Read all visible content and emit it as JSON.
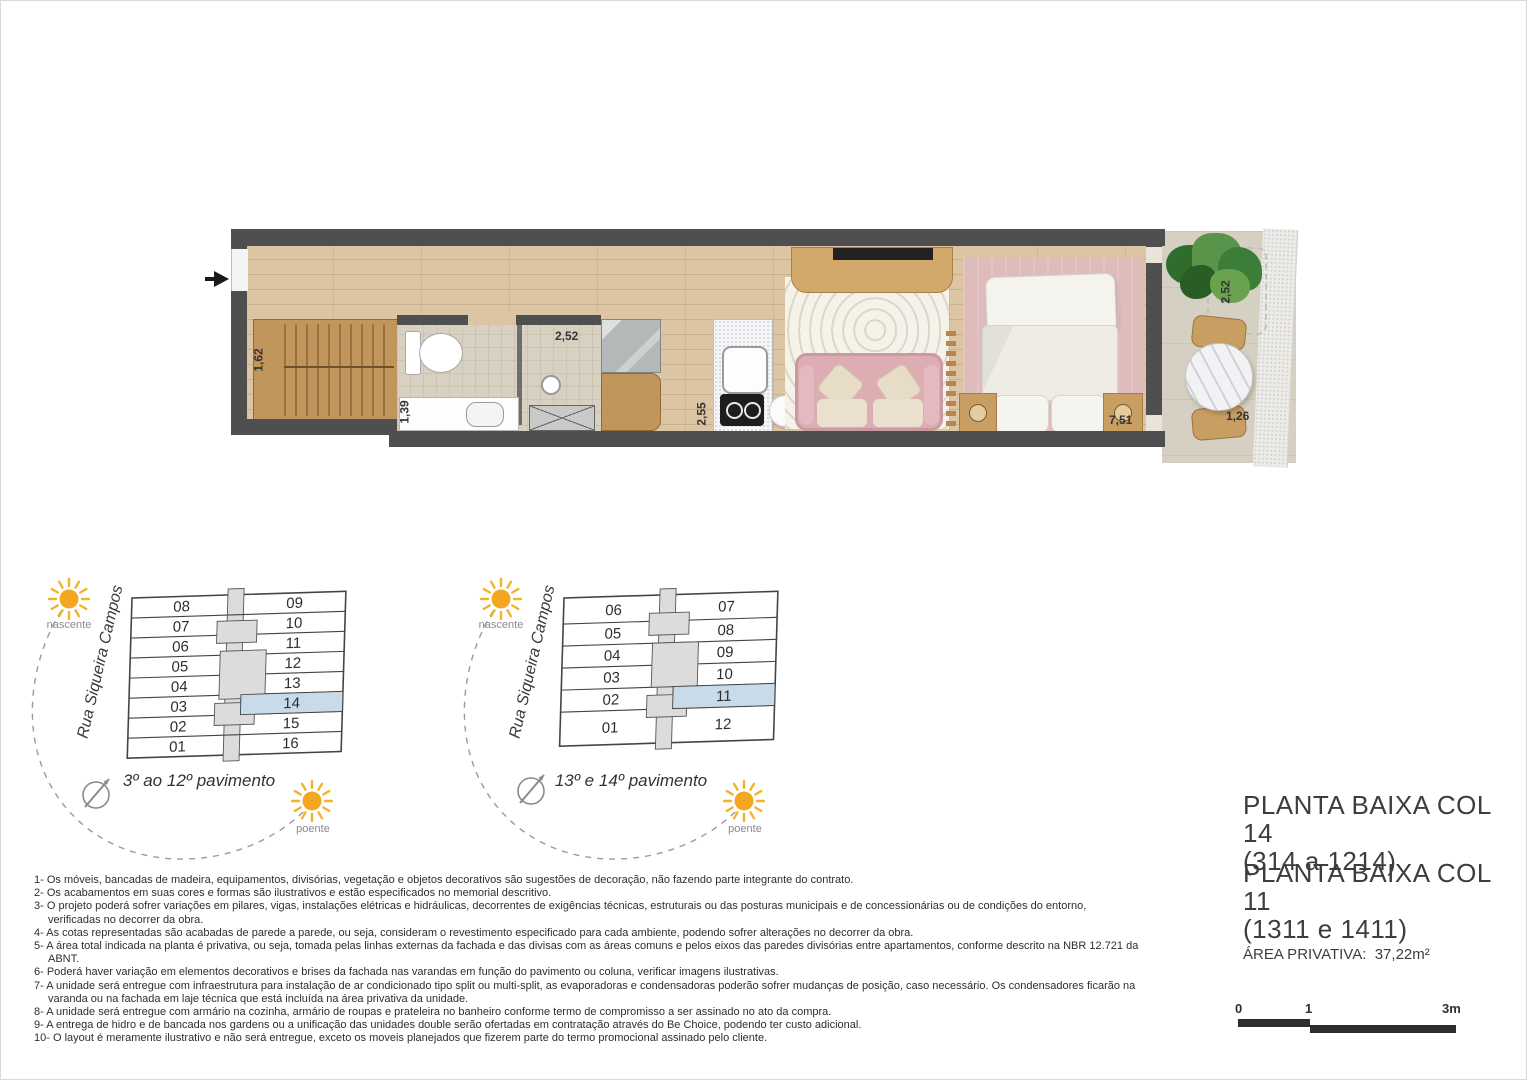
{
  "plan": {
    "dims": {
      "closet": "1,62",
      "bath_width": "2,52",
      "bath_depth": "1,39",
      "kitchen_depth": "2,55",
      "bedroom": "7,51",
      "balcony_depth": "2,52",
      "balcony_width": "1,26"
    }
  },
  "key_plans": [
    {
      "street": "Rua Siqueira Campos",
      "caption": "3º ao 12º pavimento",
      "sun_east": "nascente",
      "sun_west": "poente",
      "left_units": [
        "08",
        "07",
        "06",
        "05",
        "04",
        "03",
        "02",
        "01"
      ],
      "right_units": [
        "09",
        "10",
        "11",
        "12",
        "13",
        "14",
        "15",
        "16"
      ],
      "highlighted": "14"
    },
    {
      "street": "Rua Siqueira Campos",
      "caption": "13º e 14º pavimento",
      "sun_east": "nascente",
      "sun_west": "poente",
      "left_units": [
        "06",
        "05",
        "04",
        "03",
        "02",
        "01"
      ],
      "right_units": [
        "07",
        "08",
        "09",
        "10",
        "11",
        "12"
      ],
      "highlighted": "11"
    }
  ],
  "notes": {
    "items": [
      "1- Os móveis, bancadas de madeira, equipamentos, divisórias, vegetação e objetos decorativos são sugestões de decoração, não fazendo parte integrante do contrato.",
      "2- Os acabamentos em suas cores e formas são ilustrativos e estão especificados no memorial descritivo.",
      "3- O projeto poderá sofrer variações em pilares, vigas, instalações elétricas e hidráulicas, decorrentes de exigências técnicas, estruturais ou das posturas municipais e de concessionárias ou de condições do entorno, verificadas no decorrer da obra.",
      "4- As cotas representadas são acabadas de parede a parede, ou seja, consideram o revestimento especificado para cada ambiente, podendo sofrer alterações no decorrer da obra.",
      "5- A área total indicada na planta é privativa, ou seja, tomada pelas linhas externas da fachada e das divisas com as áreas comuns e pelos eixos das paredes divisórias entre apartamentos, conforme descrito na NBR 12.721 da ABNT.",
      "6- Poderá haver variação em elementos decorativos e brises da fachada nas varandas em função do pavimento ou coluna, verificar imagens ilustrativas.",
      "7- A unidade será entregue com infraestrutura para instalação de ar condicionado tipo split ou multi-split, as evaporadoras e condensadoras poderão sofrer mudanças de posição, caso necessário. Os condensadores ficarão na varanda ou na fachada em laje técnica que está incluída na área privativa da unidade.",
      "8- A unidade será entregue com armário na cozinha, armário de roupas e prateleira no banheiro conforme termo de compromisso a ser assinado no ato da compra.",
      "9- A entrega de hidro e de bancada nos gardens ou a unificação das unidades double serão ofertadas em contratação através do Be Choice, podendo ter custo adicional.",
      "10- O layout é meramente ilustrativo e não será entregue, exceto os moveis planejados que fizerem parte do termo promocional assinado pelo cliente."
    ]
  },
  "title_block": {
    "title1": "PLANTA BAIXA COL 14",
    "subtitle1": "(314 a 1214)",
    "title2": "PLANTA BAIXA COL 11",
    "subtitle2": "(1311 e 1411)",
    "area_label": "ÁREA PRIVATIVA:",
    "area_value": "37,22m²"
  },
  "scale_bar": {
    "tick0": "0",
    "tick1": "1",
    "tick2": "3m"
  },
  "colors": {
    "wall": "#4f4f4f",
    "wood_floor": "#dcc5a3",
    "highlight_unit": "#c9dbe9",
    "sun": "#f2a71e",
    "sofa_pink": "#dcaeb3",
    "bedroom_rug_pink": "#dfbcbc"
  }
}
